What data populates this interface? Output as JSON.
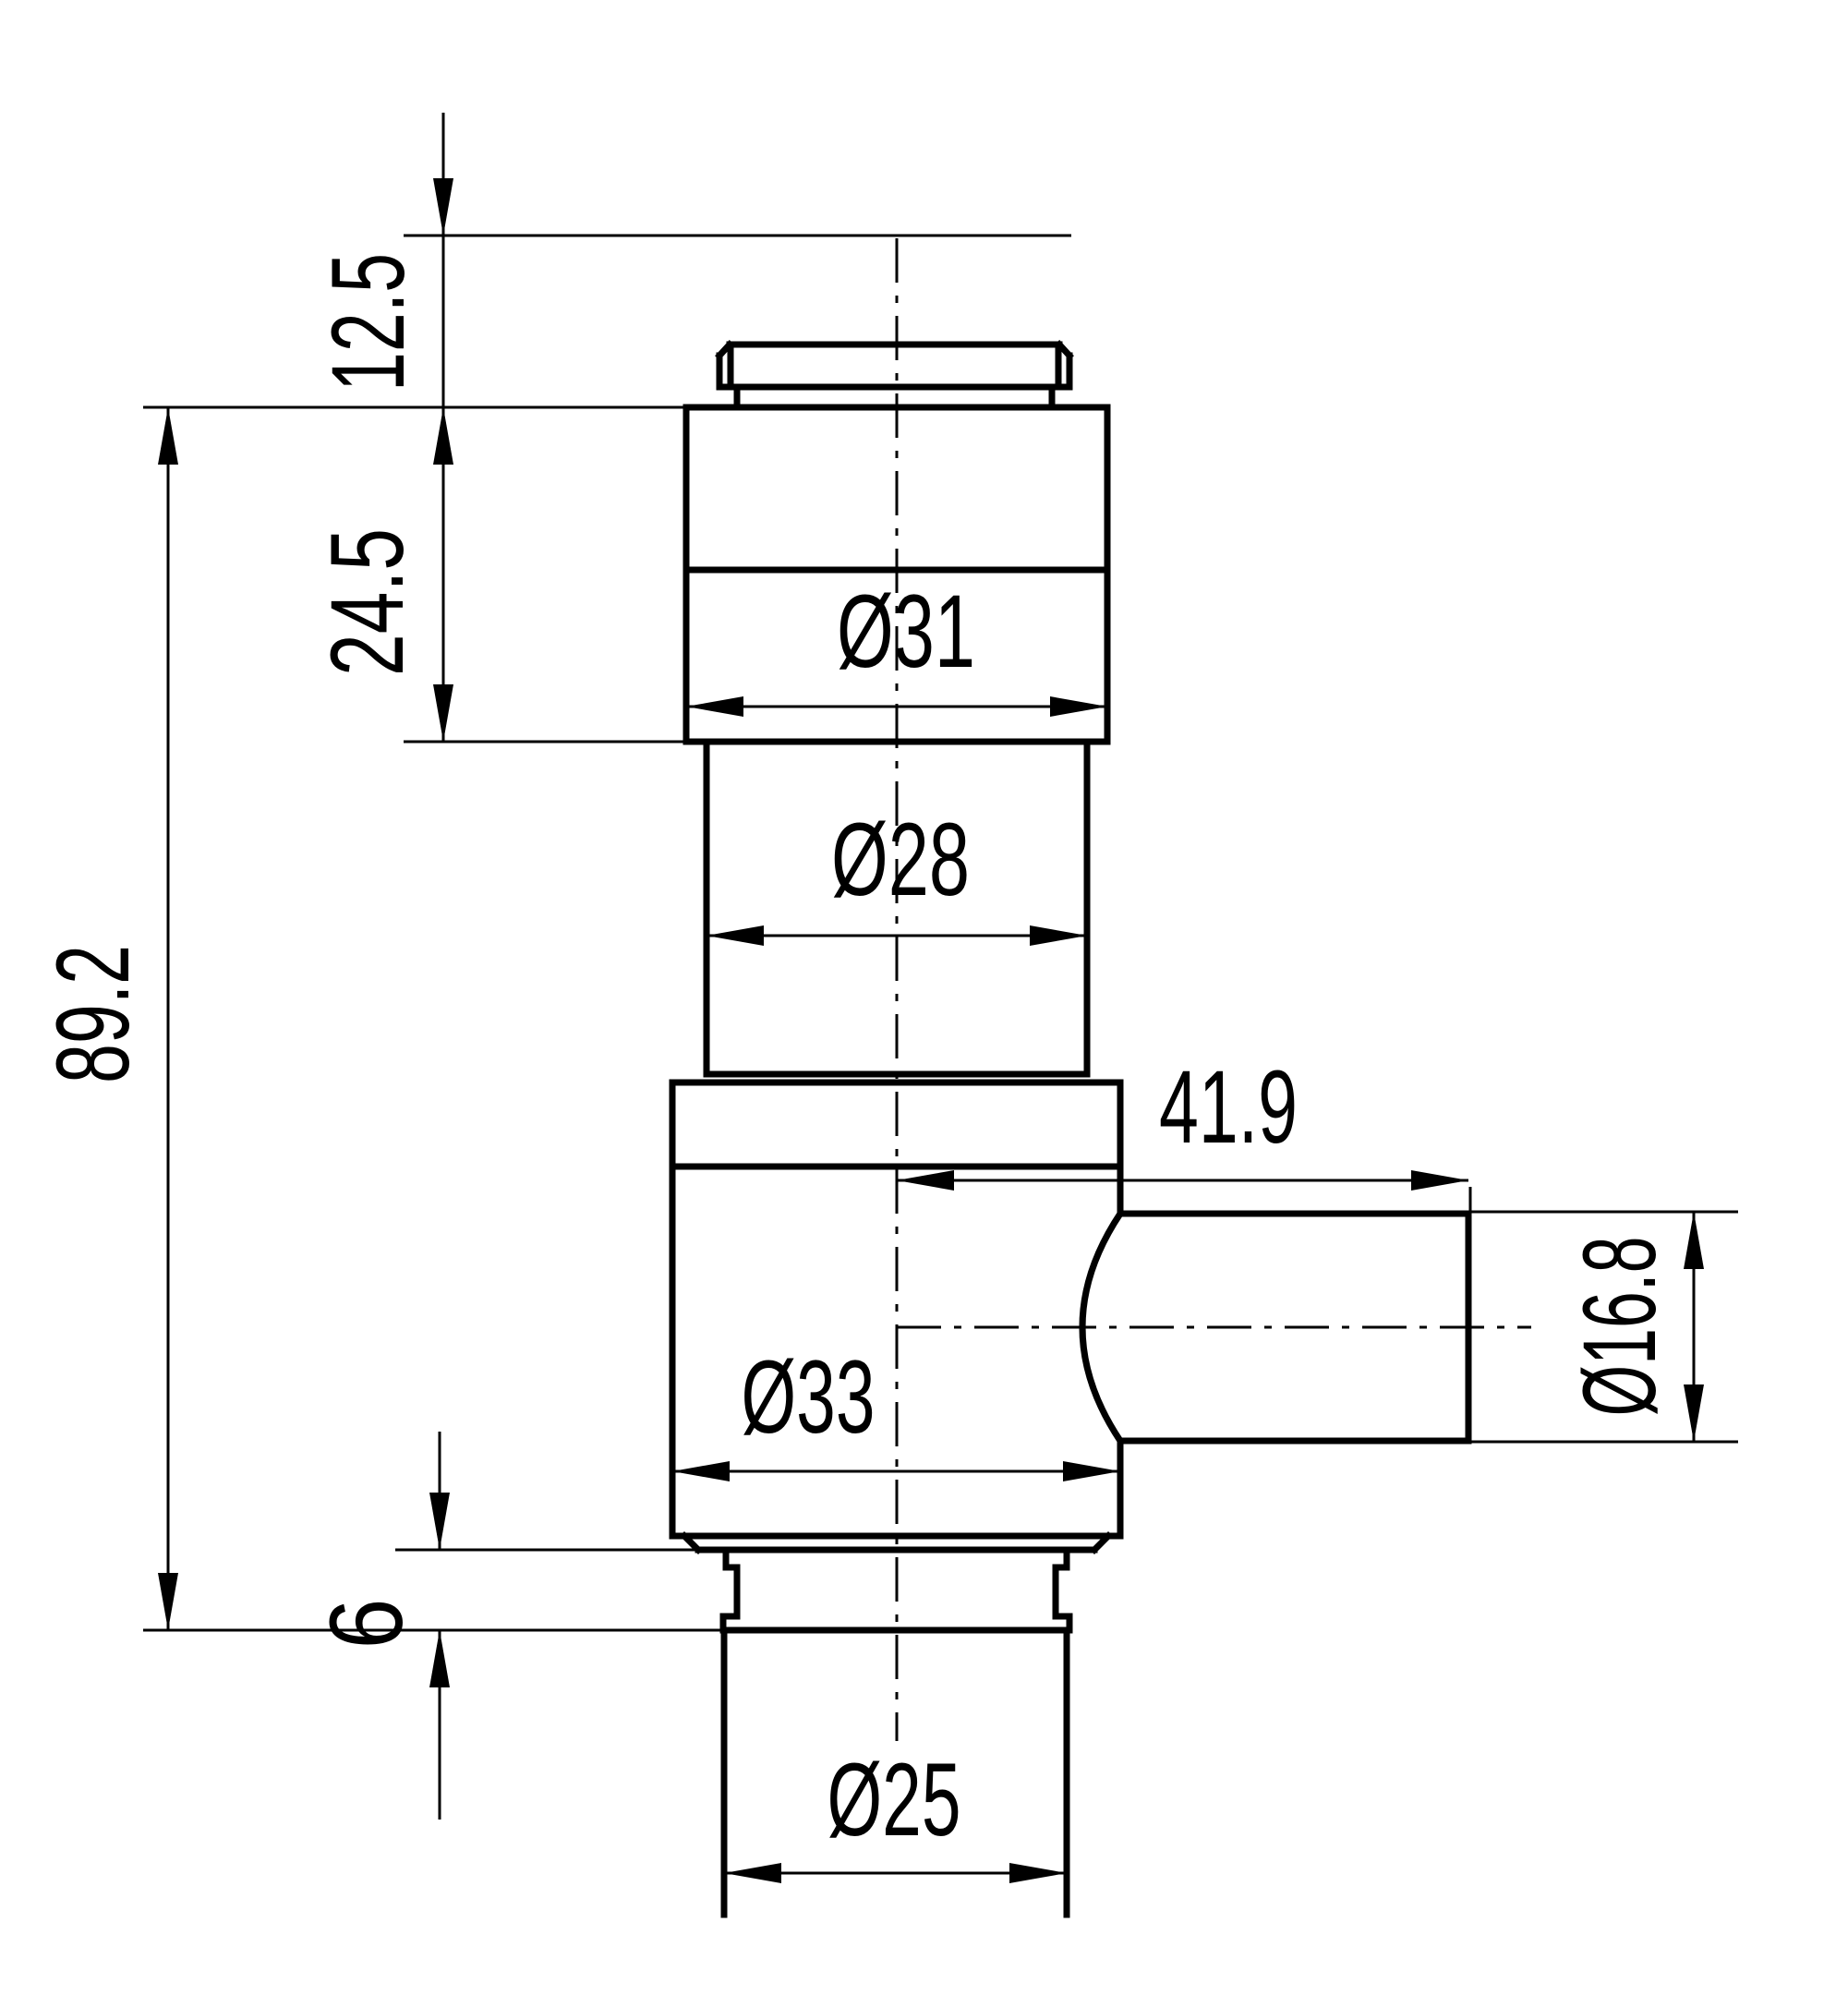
{
  "app": {
    "type": "technical-drawing",
    "description": "Dimensioned 2D engineering drawing (side section view) of a stepped cylindrical valve body with a lateral port"
  },
  "colors": {
    "background": "#ffffff",
    "line": "#000000"
  },
  "dimensions": {
    "height_12_5": {
      "label": "12.5",
      "orientation": "vertical"
    },
    "height_24_5": {
      "label": "24.5",
      "orientation": "vertical"
    },
    "height_89_2": {
      "label": "89.2",
      "orientation": "vertical"
    },
    "height_6": {
      "label": "6",
      "orientation": "vertical"
    },
    "dia_31": {
      "label": "Ø31",
      "orientation": "horizontal"
    },
    "dia_28": {
      "label": "Ø28",
      "orientation": "horizontal"
    },
    "dia_33": {
      "label": "Ø33",
      "orientation": "horizontal"
    },
    "dia_25": {
      "label": "Ø25",
      "orientation": "horizontal"
    },
    "length_41_9": {
      "label": "41.9",
      "orientation": "horizontal"
    },
    "dia_16_8": {
      "label": "Ø16.8",
      "orientation": "vertical"
    }
  }
}
